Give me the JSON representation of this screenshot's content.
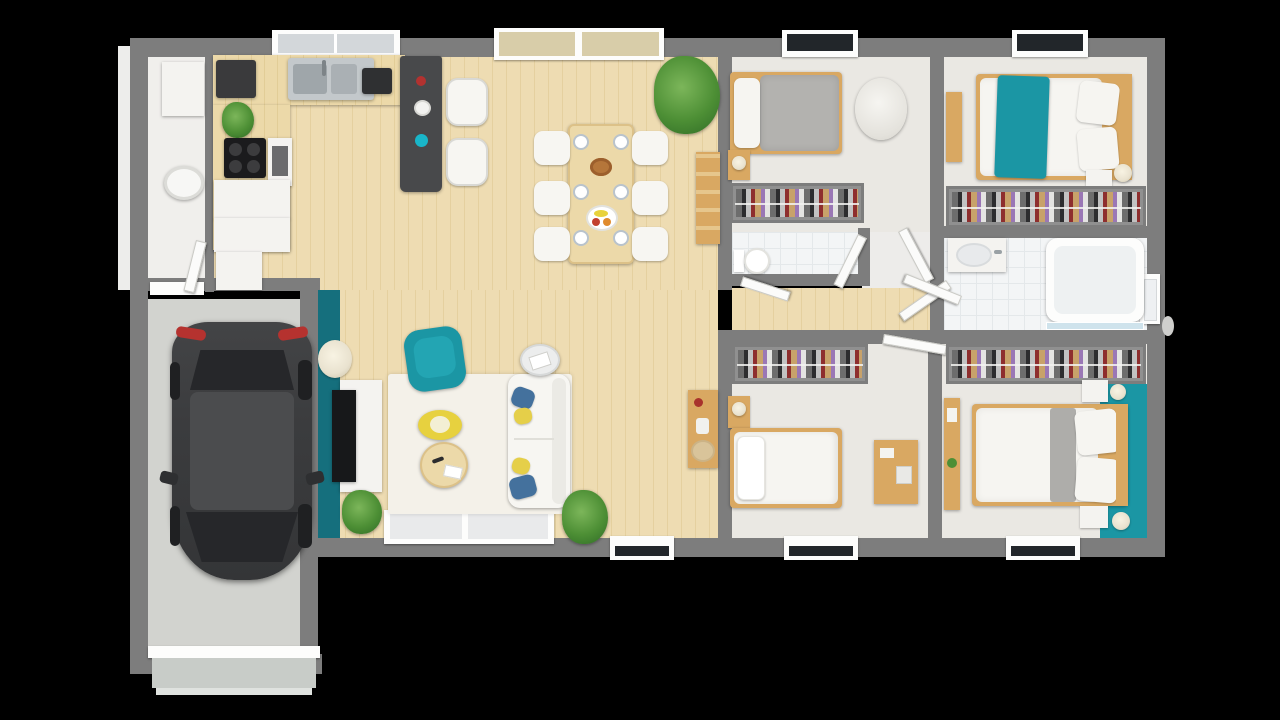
{
  "scene": {
    "kind": "3d-floor-plan-render",
    "background": "#000000"
  },
  "palette": {
    "wall": "#7d7d7d",
    "wall_light": "#ededeb",
    "wood_floor": "#eedcb2",
    "wood_floor_line": "#e5d09f",
    "carpet": "#eae8e3",
    "tile": "#f3f5f6",
    "tile_line": "#e4e8ea",
    "utility_floor": "#f0efec",
    "garage_floor": "#d2d3cf",
    "rug": "#f4f1e9",
    "accent_teal_dark": "#156f7d",
    "accent_teal": "#1b96a4",
    "furniture_wood": "#d9a862",
    "counter_wood": "#ecd9a9",
    "island_dark": "#48494b",
    "cabinet_white": "#f4f3f0",
    "sofa_white": "#f7f6f2",
    "duvet_white": "#f6f5f1",
    "blanket_gray": "#aeadaa",
    "pillow_blue": "#44719d",
    "pillow_yellow": "#e5cf49",
    "car_body": "#3b3c3e",
    "car_roof": "#4b4c4e",
    "car_glass": "#26272a",
    "taillight_red": "#b5322f",
    "window_dark": "#22262a",
    "glass_tan": "#d8cda9",
    "glass_pale": "#e9eaeb",
    "steel": "#c3c8cb",
    "lamp_cream": "#e9e2cf",
    "door_white": "#fbfbfa",
    "shower_glass": "#cfe3ec",
    "plant_green": "#4d8f35",
    "table_yellow": "#e7d13f",
    "stove_black": "#1b1b1d",
    "toilet_white": "#ffffff",
    "garage_door": "#c8ccc8"
  },
  "rooms": [
    {
      "id": "garage",
      "label": "garage"
    },
    {
      "id": "utility",
      "label": "utility-room"
    },
    {
      "id": "kitchen",
      "label": "kitchen"
    },
    {
      "id": "dining",
      "label": "dining-area"
    },
    {
      "id": "living",
      "label": "living-room"
    },
    {
      "id": "hallway",
      "label": "hallway"
    },
    {
      "id": "bedroom-1",
      "label": "bedroom-1"
    },
    {
      "id": "wc",
      "label": "wc"
    },
    {
      "id": "bedroom-2",
      "label": "bedroom-2"
    },
    {
      "id": "bathroom",
      "label": "bathroom"
    },
    {
      "id": "bedroom-3",
      "label": "bedroom-3"
    },
    {
      "id": "bedroom-4",
      "label": "bedroom-4"
    }
  ],
  "furniture": {
    "garage": [
      "car",
      "garage-door"
    ],
    "utility": [
      "wall-cabinet",
      "washer"
    ],
    "kitchen": [
      "sink",
      "coffee-machine",
      "toaster",
      "cooktop",
      "oven-column",
      "base-cabinets",
      "bar-island",
      "bar-stools",
      "plant"
    ],
    "dining": [
      "table-6-seats",
      "chairs",
      "plates",
      "fruit-bowls",
      "large-plant",
      "ladder-shelf",
      "console-table"
    ],
    "living": [
      "tv-wall-teal",
      "tv",
      "tv-stand",
      "floor-lamp",
      "rug",
      "armchair-teal",
      "coffee-table-yellow",
      "coffee-table-wood",
      "sofa-white",
      "side-table",
      "plants",
      "sliding-glass-door"
    ],
    "bedroom1": [
      "single-bed-gray",
      "nightstand",
      "beanbag",
      "open-closet"
    ],
    "bedroom2": [
      "double-bed-teal-throw",
      "nightstand",
      "table-lamp",
      "open-closet"
    ],
    "bedroom3": [
      "double-bed-gray-runner",
      "two-nightstands",
      "table-lamps",
      "desk",
      "teal-accent-wall",
      "open-closet"
    ],
    "bedroom4": [
      "single-bed-white",
      "nightstand",
      "desk",
      "open-closet"
    ],
    "bathroom": [
      "vanity-sink",
      "bathtub",
      "shower-screen"
    ],
    "wc": [
      "toilet"
    ]
  }
}
